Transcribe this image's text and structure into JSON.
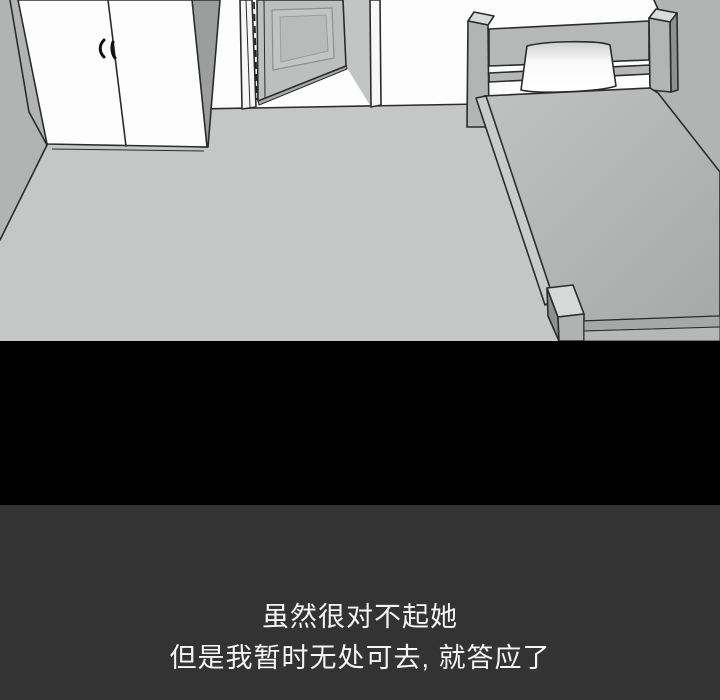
{
  "panel": {
    "scene_objects": [
      "wardrobe",
      "open-door",
      "door-frame",
      "bed",
      "headboard",
      "pillow",
      "mattress",
      "bed-foot-post"
    ],
    "colors": {
      "floor": "#c5c7c6",
      "wall_side": "#b2b4b3",
      "wall_white": "#fcfdfc",
      "furniture": "#b6b8b7",
      "wardrobe_side": "#9c9e9d",
      "door_leaf": "#bdbfbe",
      "outline": "#2b2b2b",
      "black_band": "#000000",
      "caption_bg": "#333333",
      "caption_text": "#f5f5f5"
    },
    "caption": {
      "lines": [
        "虽然很对不起她",
        "但是我暂时无处可去, 就答应了"
      ]
    }
  }
}
